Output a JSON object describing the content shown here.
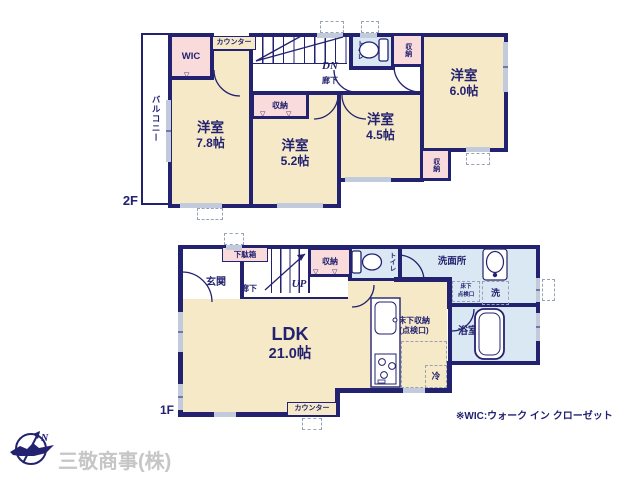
{
  "colors": {
    "wall": "#232270",
    "floor": "#f5e9c7",
    "closet": "#f9dbdb",
    "wet": "#d9e8f2",
    "window": "#c2cbdc"
  },
  "symbols": {
    "closet_mark": "▽"
  },
  "floor2": {
    "floor_label": "2F",
    "balcony": "バルコニー",
    "wic": "WIC",
    "counter": "カウンター",
    "stairs_down": "DN",
    "hallway": "廊下",
    "toilet": "トイレ",
    "storage": "収納",
    "rooms": {
      "west": {
        "name": "洋室",
        "size": "7.8帖"
      },
      "center": {
        "name": "洋室",
        "size": "5.2帖"
      },
      "east": {
        "name": "洋室",
        "size": "4.5帖"
      },
      "northeast": {
        "name": "洋室",
        "size": "6.0帖"
      }
    }
  },
  "floor1": {
    "floor_label": "1F",
    "entrance": "玄関",
    "shoe_cabinet": "下駄箱",
    "hallway": "廊下",
    "stairs_up": "UP",
    "storage": "収納",
    "toilet": "トイレ",
    "washroom": "洗面所",
    "underfloor_hatch": {
      "line1": "床下",
      "line2": "点検口"
    },
    "washer": "洗",
    "bathroom": "浴室",
    "underfloor_storage": {
      "line1": "床下収納",
      "line2": "(点検口)"
    },
    "ldk": {
      "name": "LDK",
      "size": "21.0帖"
    },
    "fridge": "冷",
    "counter": "カウンター"
  },
  "footer": {
    "note": "※WIC:ウォーク イン クローゼット",
    "company": "三敬商事(株)",
    "compass_north": "N"
  }
}
